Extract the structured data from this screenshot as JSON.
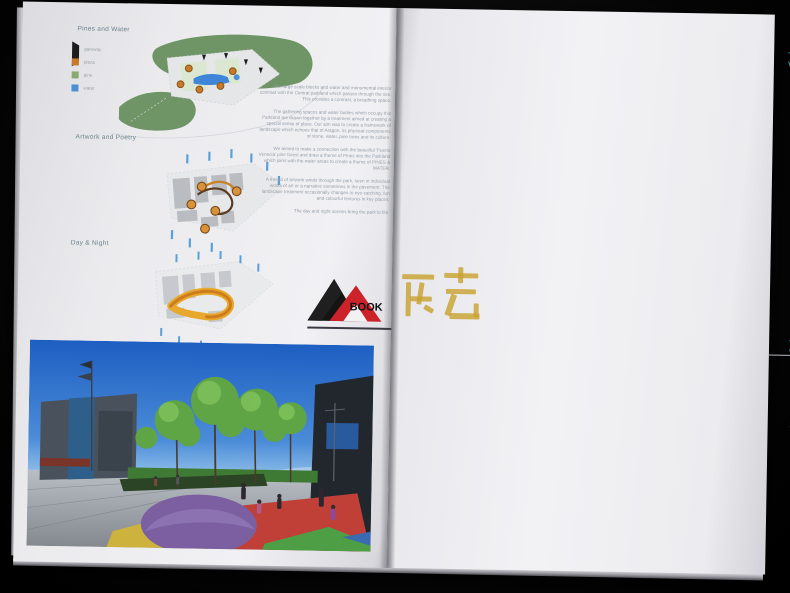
{
  "left_page": {
    "section1_title": "Pines and Water",
    "section2_title": "Artwork and Poetry",
    "section3_title": "Day & Night",
    "legend": {
      "items": [
        {
          "label": "gateway"
        },
        {
          "label": "plaza"
        },
        {
          "label": "pine"
        },
        {
          "label": "water"
        }
      ]
    },
    "essay": {
      "para1": "The large scale blocks and water and monumental interior contrast with the Central parkland which passes through the site. This provides a contrast, a breathing space.",
      "para2": "The gathering spaces and water bodies which occupy this Parkland are drawn together by a treatment aimed at creating a special sense of place. Our aim was to create a framework of landscape which echoes that of Aragon, its physical components of stone, water, pine trees and its culture.",
      "para3": "We aimed to make a connection with the beautiful 'Puerto Venecia' pine forest and draw a theme of Pines into the Parkland which joins with the water areas to create a theme of PINES & WATER.",
      "para4": "A thread of artwork winds through the park, seen in individual works of art or a narrative sometimes in the pavement. The landscape treatment occasionally changes to eye-catching, fun and colourful textures in key places.",
      "para5": "The day and night scenes bring the park to life."
    }
  },
  "right_page": {
    "arrival": {
      "vision_label": "The Vision:",
      "title": "The Arrival Sequence",
      "legend_title": "LEGEND",
      "legend": [
        {
          "label": "Arrival sequence"
        },
        {
          "label": "Principal Gateway landmark"
        },
        {
          "label": "Secondary gateway landmark"
        },
        {
          "label": "Housing"
        },
        {
          "label": "Town Centre"
        }
      ],
      "thumbnails": [
        {
          "caption": "Principal Gateways",
          "sub": "to mark arrival points"
        },
        {
          "caption": "Gateways",
          "sub": "taking in the plaza defined by local building, green colour"
        },
        {
          "caption": "Parking",
          "sub": "tree lined with clean plaza streets"
        },
        {
          "caption": "Town centre",
          "sub": "defined by distinctive towers"
        },
        {
          "caption": "Town centre",
          "sub": "arrival by underpass and canal"
        },
        {
          "caption": "Town centre",
          "sub": "framed views along streets"
        },
        {
          "caption": "Town centre",
          "sub": "artful views at street level"
        },
        {
          "caption": "Town centre",
          "sub": "water feature on the arrival axis"
        }
      ]
    },
    "town_centre": {
      "vision_label": "The Vision:",
      "title": "The Town Centre",
      "desc_label": "GENERAL DESCRIPTION",
      "intro": "The Town Centre site analysed in its:",
      "bullets": [
        "a square",
        "two lakes",
        "small green paths",
        "lakeside walk"
      ],
      "para": "Several small items link through activities that will be addressed ensuring real improvement social and environmental."
    },
    "panels": [
      {
        "title": "THE PARK",
        "line1": "a sequence of lawns, play hills and picnic",
        "line2": "places set among the pines",
        "labels": [
          "the green",
          "play hills",
          "picnic lawn"
        ]
      },
      {
        "title": "CANALSIDE",
        "line1": "an active edge of cafes and arcades",
        "line2": "fronting the canal walk",
        "labels": [
          "market hall",
          "arcade",
          "canal walk"
        ]
      },
      {
        "title": "LAKESIDE // THE BEACH",
        "line1": "a boardwalk and beach at the water's",
        "line2": "edge for events and leisure",
        "labels": [
          "boardwalk",
          "the beach",
          "jetty"
        ]
      },
      {
        "title": "THE COVE",
        "line1": "quiet gardens and lookouts",
        "line2": "by the water",
        "labels": [
          "the cove",
          "gardens",
          "lookout"
        ]
      }
    ]
  },
  "watermark": {
    "book_label": "BOOK",
    "cjk_label": "筑艺"
  }
}
